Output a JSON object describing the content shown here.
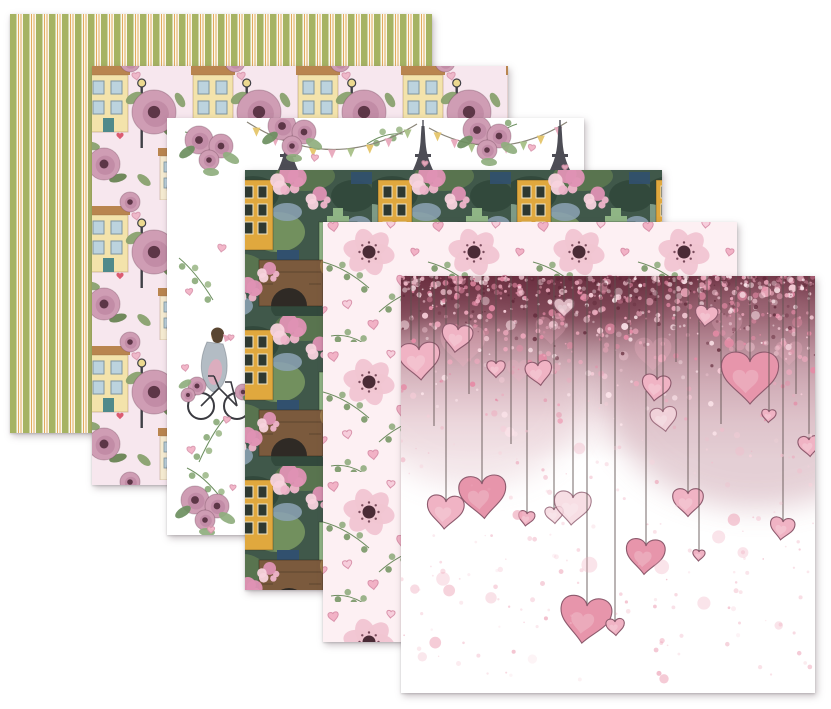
{
  "scene": {
    "description": "Six fanned square scrapbook papers, Paris-in-love watercolor theme, on a white background",
    "background_color": "#ffffff"
  },
  "papers": [
    {
      "name": "green-stripes-paper",
      "label": "Olive and cream stripes",
      "colors": {
        "green": "#a6b363",
        "cream": "#fbf8ec",
        "tangerine": "#e3aa5e"
      },
      "stripe_unit_px": 13
    },
    {
      "name": "town-roses-paper",
      "label": "Town houses and mauve roses on pale pink",
      "colors": {
        "bg": "#f7e7ee",
        "house": "#f3e3ab",
        "house2": "#f6ecd2",
        "roof": "#b9854f",
        "window": "#bcd3de",
        "window_frame": "#7e95a0",
        "door_teal": "#4f8a8b",
        "door_orange": "#cd7f45",
        "rose": "#cf9db4",
        "rose_inner": "#c08aa4",
        "rose_dark": "#5d3647",
        "leaf": "#87a06b",
        "leaf_dark": "#66814f",
        "lamp": "#3f3f46",
        "heart_red": "#d9536a",
        "heart_pink": "#eeb3c6",
        "heart_line": "#d893ab"
      }
    },
    {
      "name": "paris-bicycle-paper",
      "label": "White paper with Eiffel towers, bunting, hearts and girl on bicycle",
      "colors": {
        "bg": "#ffffff",
        "tower": "#4d4d55",
        "heart": "#f2b0c4",
        "heart_line": "#d893ab",
        "leaf": "#8fae7e",
        "leaf2": "#a3bd90",
        "leaf_dark": "#6d8f60",
        "rose": "#cf9db4",
        "rose_inner": "#c08aa4",
        "rose_dark": "#5d3647",
        "flag_yellow": "#e5c56a",
        "flag_green": "#a8c087",
        "flag_pink": "#e8a8bc",
        "string": "#8a8578",
        "dress": "#b3bcc4",
        "skin": "#e8c9a8",
        "hair": "#5a4632",
        "bike": "#3a3a40"
      },
      "tower_positions": [
        121,
        256,
        393
      ]
    },
    {
      "name": "blossom-town-paper",
      "label": "Dense watercolor town with cherry blossoms, bridge and lanterns",
      "colors": {
        "bg": "#40584a",
        "foliage1": "#32493c",
        "foliage2": "#59744f",
        "foliage3": "#72905e",
        "foliage4": "#7d9a86",
        "stone": "#8ca3b5",
        "navy": "#31506e",
        "yellow_house": "#e0a83e",
        "green_house": "#8fb585",
        "window_dark": "#2e3830",
        "bridge": "#7b5a3d",
        "arch": "#2f2a25",
        "blossom1": "#efb5ca",
        "blossom2": "#f7d2dd",
        "blossom3": "#df92b4",
        "lantern": "#f2cf6f"
      }
    },
    {
      "name": "hearts-anemones-paper",
      "label": "Pink hearts, eucalyptus and anemones on blush",
      "colors": {
        "bg": "#fdf0f3",
        "heart": "#f2afc4",
        "heart_pale": "#f7cddb",
        "heart_line": "#d88ea8",
        "petal": "#f2c6d2",
        "petal_line": "#d28ca5",
        "center": "#4a2b36",
        "leaf": "#7f9c6f",
        "leaf2": "#97b086",
        "leaf_dark": "#6e8c60",
        "rosebud": "#e5a8bd"
      }
    },
    {
      "name": "hanging-hearts-paper",
      "label": "Watercolor hearts hanging on strings under rose glitter",
      "colors": {
        "bg": "#ffffff",
        "band_dark": "#6a2e3f",
        "band_mid": "#a76f7f",
        "haze": "#c18f9d",
        "string": "#5d504e",
        "outline": "#8d5a6d",
        "tone_pale": "#f6d6de",
        "tone_mid": "#f0b3c4",
        "tone_deep": "#e795ab",
        "speckle1": "#f7cdd8",
        "speckle2": "#eea9bd",
        "speckle3": "#e58ba6",
        "speckle4": "#fbe3e9",
        "speckle_dark": "#5f2838",
        "splatter1": "#f3bccb",
        "splatter2": "#eda4b8",
        "splatter3": "#f7d3dc"
      },
      "strings": [
        {
          "x": 10,
          "len": 64,
          "size": 0
        },
        {
          "x": 18,
          "len": 74,
          "size": 40,
          "tone": "mid"
        },
        {
          "x": 33,
          "len": 150,
          "size": 0
        },
        {
          "x": 45,
          "len": 226,
          "size": 36,
          "tone": "mid"
        },
        {
          "x": 57,
          "len": 54,
          "size": 30,
          "tone": "mid"
        },
        {
          "x": 68,
          "len": 118,
          "size": 0
        },
        {
          "x": 81,
          "len": 208,
          "size": 46,
          "tone": "deep"
        },
        {
          "x": 95,
          "len": 88,
          "size": 18,
          "tone": "mid"
        },
        {
          "x": 110,
          "len": 168,
          "size": 0
        },
        {
          "x": 126,
          "len": 238,
          "size": 16,
          "tone": "mid"
        },
        {
          "x": 137,
          "len": 90,
          "size": 26,
          "tone": "mid"
        },
        {
          "x": 153,
          "len": 234,
          "size": 18,
          "tone": "pale"
        },
        {
          "x": 163,
          "len": 26,
          "size": 20,
          "tone": "pale"
        },
        {
          "x": 172,
          "len": 222,
          "size": 36,
          "tone": "pale"
        },
        {
          "x": 186,
          "len": 330,
          "size": 50,
          "tone": "deep"
        },
        {
          "x": 200,
          "len": 128,
          "size": 0
        },
        {
          "x": 214,
          "len": 346,
          "size": 18,
          "tone": "mid"
        },
        {
          "x": 228,
          "len": 58,
          "size": 0
        },
        {
          "x": 245,
          "len": 270,
          "size": 38,
          "tone": "deep"
        },
        {
          "x": 256,
          "len": 104,
          "size": 28,
          "tone": "mid"
        },
        {
          "x": 262,
          "len": 136,
          "size": 26,
          "tone": "pale"
        },
        {
          "x": 275,
          "len": 86,
          "size": 0
        },
        {
          "x": 287,
          "len": 218,
          "size": 30,
          "tone": "mid"
        },
        {
          "x": 298,
          "len": 276,
          "size": 12,
          "tone": "mid"
        },
        {
          "x": 306,
          "len": 34,
          "size": 22,
          "tone": "mid"
        },
        {
          "x": 320,
          "len": 148,
          "size": 0
        },
        {
          "x": 335,
          "len": 76,
          "size": 0
        },
        {
          "x": 349,
          "len": 86,
          "size": 56,
          "tone": "deep"
        },
        {
          "x": 368,
          "len": 136,
          "size": 14,
          "tone": "mid"
        },
        {
          "x": 382,
          "len": 246,
          "size": 24,
          "tone": "mid"
        },
        {
          "x": 395,
          "len": 118,
          "size": 0
        },
        {
          "x": 408,
          "len": 164,
          "size": 22,
          "tone": "mid"
        }
      ]
    }
  ]
}
